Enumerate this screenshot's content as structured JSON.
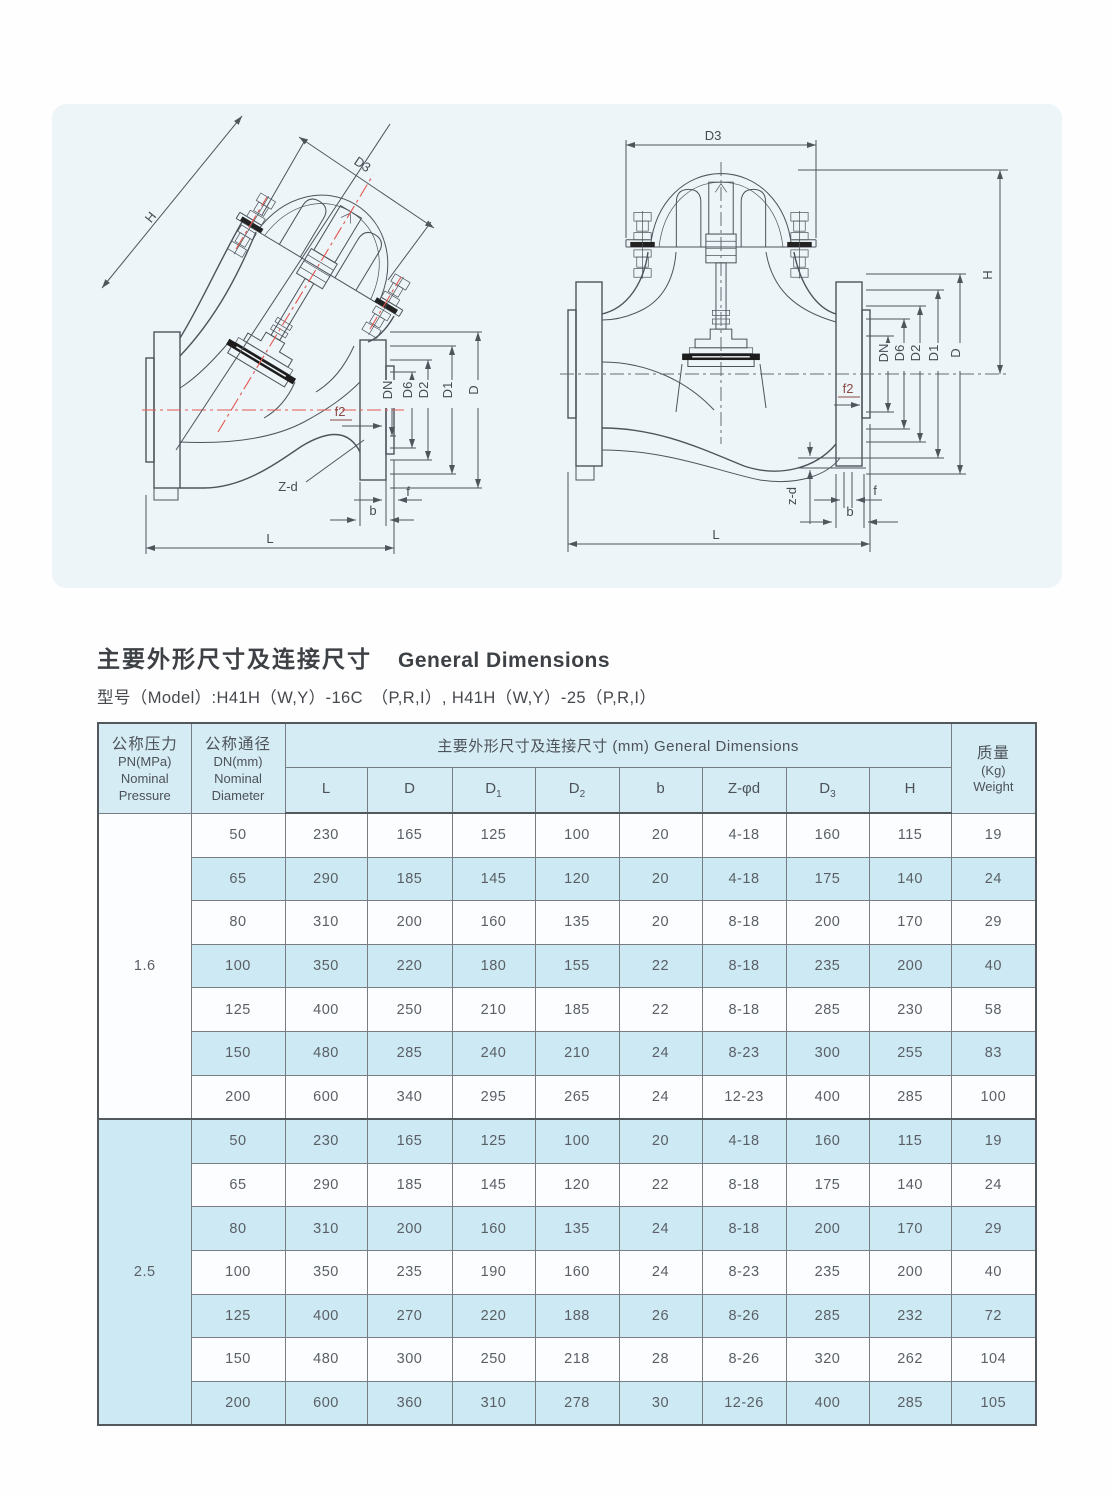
{
  "page": {
    "title_zh": "主要外形尺寸及连接尺寸",
    "title_en": "General Dimensions",
    "model_line": "型号（Model）:H41H（W,Y）-16C　（P,R,I）, H41H（W,Y）-25（P,R,I）"
  },
  "colors": {
    "row_blue": "#cde9f3",
    "row_white": "#fbfdfe",
    "header_blue": "#d5ecf5",
    "border_dark": "#53585d",
    "centerline_red": "#e2574e",
    "text_gray": "#5a5f66"
  },
  "drawing_labels": {
    "H": "H",
    "D3": "D3",
    "DN": "DN",
    "D6": "D6",
    "D2": "D2",
    "D1": "D1",
    "D": "D",
    "f2": "f2",
    "Zd": "Z-d",
    "zd": "z-d",
    "f": "f",
    "b": "b",
    "L": "L"
  },
  "table": {
    "header": {
      "pn_lines": [
        "公称压力",
        "PN(MPa)",
        "Nominal",
        "Pressure"
      ],
      "dn_lines": [
        "公称通径",
        "DN(mm)",
        "Nominal",
        "Diameter"
      ],
      "span_title": "主要外形尺寸及连接尺寸  (mm)  General Dimensions",
      "sub_headers": [
        {
          "base": "L",
          "sub": ""
        },
        {
          "base": "D",
          "sub": ""
        },
        {
          "base": "D",
          "sub": "1"
        },
        {
          "base": "D",
          "sub": "2"
        },
        {
          "base": "b",
          "sub": ""
        },
        {
          "base": "Z-φd",
          "sub": ""
        },
        {
          "base": "D",
          "sub": "3"
        },
        {
          "base": "H",
          "sub": ""
        }
      ],
      "weight_lines": [
        "质量",
        "(Kg)",
        "Weight"
      ]
    },
    "sections": [
      {
        "pn": "1.6",
        "rows": [
          [
            "50",
            "230",
            "165",
            "125",
            "100",
            "20",
            "4-18",
            "160",
            "115",
            "19"
          ],
          [
            "65",
            "290",
            "185",
            "145",
            "120",
            "20",
            "4-18",
            "175",
            "140",
            "24"
          ],
          [
            "80",
            "310",
            "200",
            "160",
            "135",
            "20",
            "8-18",
            "200",
            "170",
            "29"
          ],
          [
            "100",
            "350",
            "220",
            "180",
            "155",
            "22",
            "8-18",
            "235",
            "200",
            "40"
          ],
          [
            "125",
            "400",
            "250",
            "210",
            "185",
            "22",
            "8-18",
            "285",
            "230",
            "58"
          ],
          [
            "150",
            "480",
            "285",
            "240",
            "210",
            "24",
            "8-23",
            "300",
            "255",
            "83"
          ],
          [
            "200",
            "600",
            "340",
            "295",
            "265",
            "24",
            "12-23",
            "400",
            "285",
            "100"
          ]
        ]
      },
      {
        "pn": "2.5",
        "rows": [
          [
            "50",
            "230",
            "165",
            "125",
            "100",
            "20",
            "4-18",
            "160",
            "115",
            "19"
          ],
          [
            "65",
            "290",
            "185",
            "145",
            "120",
            "22",
            "8-18",
            "175",
            "140",
            "24"
          ],
          [
            "80",
            "310",
            "200",
            "160",
            "135",
            "24",
            "8-18",
            "200",
            "170",
            "29"
          ],
          [
            "100",
            "350",
            "235",
            "190",
            "160",
            "24",
            "8-23",
            "235",
            "200",
            "40"
          ],
          [
            "125",
            "400",
            "270",
            "220",
            "188",
            "26",
            "8-26",
            "285",
            "232",
            "72"
          ],
          [
            "150",
            "480",
            "300",
            "250",
            "218",
            "28",
            "8-26",
            "320",
            "262",
            "104"
          ],
          [
            "200",
            "600",
            "360",
            "310",
            "278",
            "30",
            "12-26",
            "400",
            "285",
            "105"
          ]
        ]
      }
    ]
  }
}
